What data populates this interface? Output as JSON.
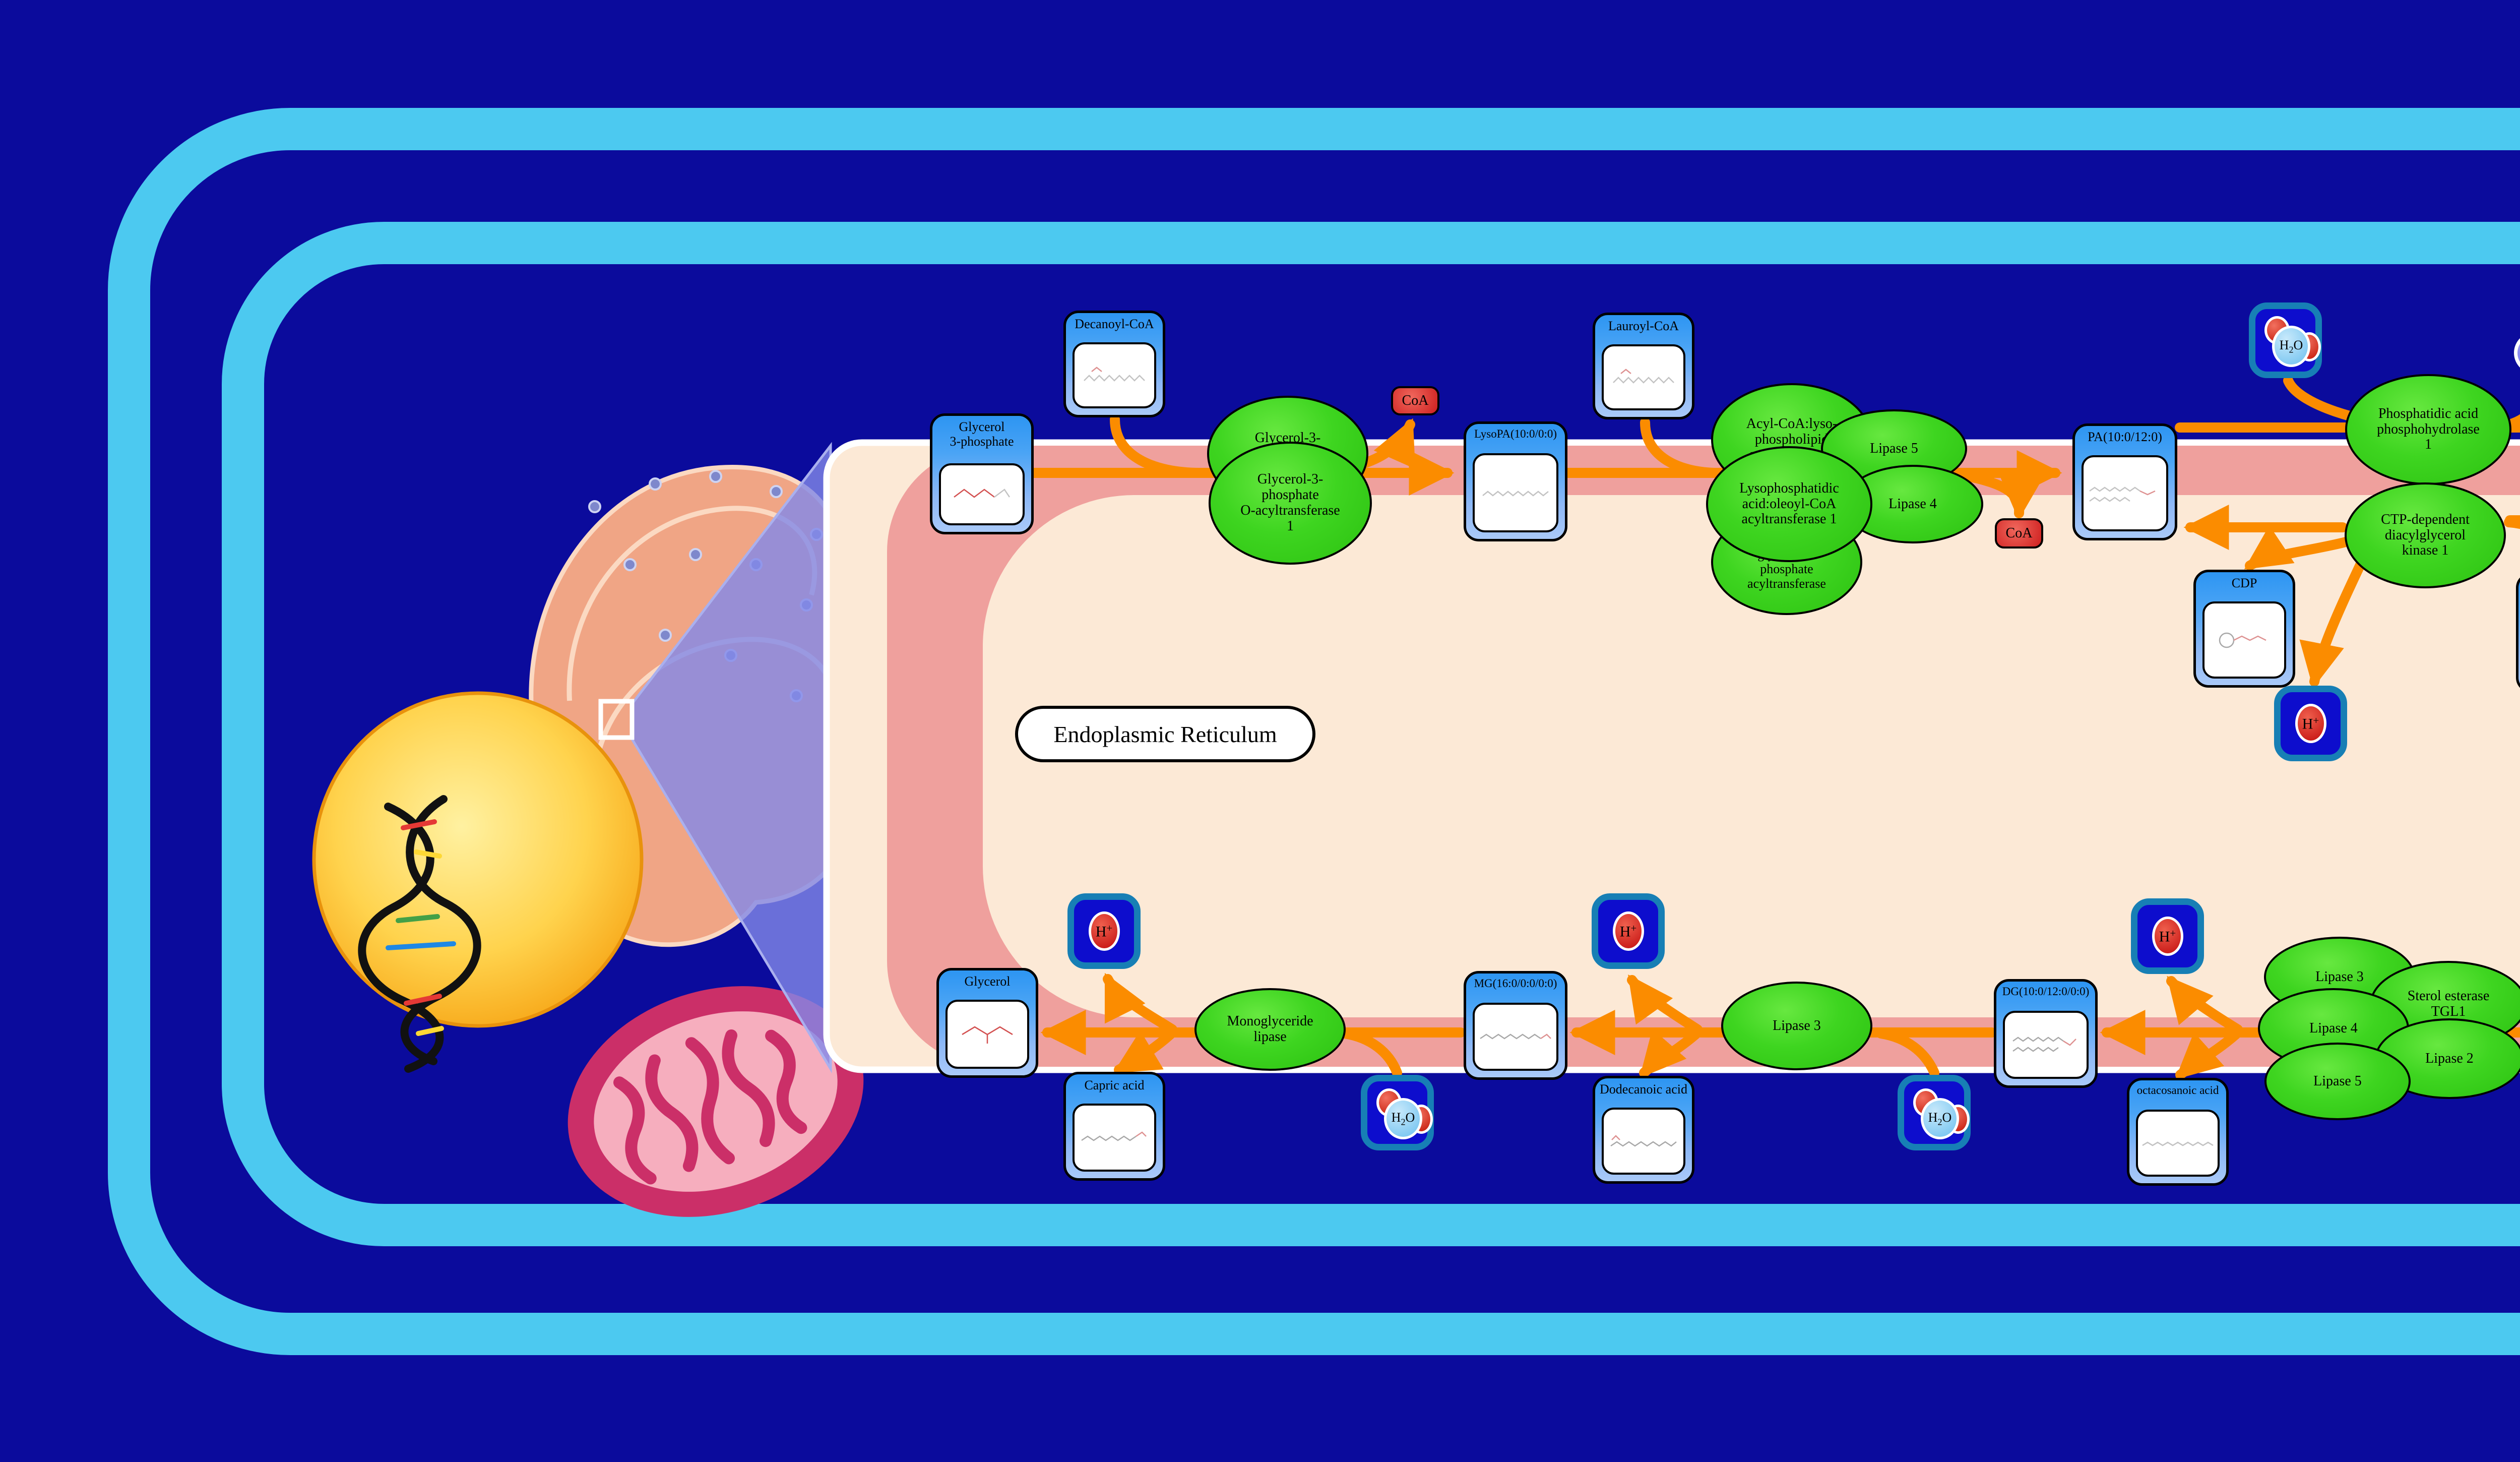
{
  "er_label": "Endoplasmic Reticulum",
  "metabolites": {
    "decanoyl_coa": {
      "label": "Decanoyl-CoA"
    },
    "glycerol_3_phosphate": {
      "label": "Glycerol\n3-phosphate"
    },
    "lysopa": {
      "label": "LysoPA(10:0/0:0)"
    },
    "lauroyl_coa": {
      "label": "Lauroyl-CoA"
    },
    "pa": {
      "label": "PA(10:0/12:0)"
    },
    "dg_top": {
      "label": "DG(10:0/12:0/0:0)"
    },
    "cdp": {
      "label": "CDP"
    },
    "ctp": {
      "label": "Cytidine\ntriphosphate"
    },
    "octacosanoyl_coa": {
      "label": "Octacosanoyl-CoA"
    },
    "tg": {
      "label": "TG(10:0/12:0/28:0)"
    },
    "glycerol": {
      "label": "Glycerol"
    },
    "capric_acid": {
      "label": "Capric acid"
    },
    "mg": {
      "label": "MG(16:0/0:0/0:0)"
    },
    "dodecanoic_acid": {
      "label": "Dodecanoic acid"
    },
    "dg_bottom": {
      "label": "DG(10:0/12:0/0:0)"
    },
    "octacosanoic_acid": {
      "label": "octacosanoic acid"
    }
  },
  "enzymes": {
    "gpat": {
      "label": "Glycerol-3-\nphosphate\nO-acyltransferase"
    },
    "gpat1": {
      "label": "Glycerol-3-\nphosphate\nO-acyltransferase\n1"
    },
    "aclat": {
      "label": "Acyl-CoA:lyso-\nphospholipid\nacyltransferase"
    },
    "lipase5_top": {
      "label": "Lipase 5"
    },
    "lpaat1": {
      "label": "Lysophosphatidic\nacid:oleoyl-CoA\nacyltransferase 1"
    },
    "lipase4_top": {
      "label": "Lipase 4"
    },
    "agpat": {
      "label": "1-acyl-sn-\nglycerol-3-\nphosphate\nacyltransferase"
    },
    "pap1": {
      "label": "Phosphatidic acid\nphosphohydrolase\n1"
    },
    "cdk1": {
      "label": "CTP-dependent\ndiacylglycerol\nkinase 1"
    },
    "dgat1": {
      "label": "Diacylglycerol\nO-acyltransferase\n1"
    },
    "mgl": {
      "label": "Monoglyceride\nlipase"
    },
    "lipase3_mid": {
      "label": "Lipase 3"
    },
    "lipase3_b": {
      "label": "Lipase 3"
    },
    "lipase4_b": {
      "label": "Lipase 4"
    },
    "lipase5_b": {
      "label": "Lipase 5"
    },
    "sterol_tgl1": {
      "label": "Sterol esterase\nTGL1"
    },
    "lipase2_b": {
      "label": "Lipase 2"
    }
  },
  "small_molecules": {
    "coa": {
      "label": "CoA"
    },
    "h2o": {
      "h": "H",
      "sub": "2",
      "o": "O"
    },
    "proton": {
      "h": "H",
      "sup": "+"
    },
    "pi": {
      "p": "P",
      "sub": "i"
    }
  },
  "colors": {
    "background_navy": "#0b0b9c",
    "cell_membrane_blue": "#4cc9f0",
    "er_membrane_salmon": "#efa09d",
    "er_lumen_cream": "#fce9d6",
    "arrow_orange": "#fb8c00",
    "enzyme_green": "#3ed520",
    "node_blue": "#2d95f2",
    "coa_red": "#ce1f1f",
    "water_chip_blue": "#0d0dcd",
    "proton_red": "#c30f0f",
    "pi_purple": "#6767e6",
    "nucleus_orange": "#f59d0c",
    "mitochondrion_pink": "#cb2f68",
    "zoom_cone_purple": "#8288e8"
  }
}
